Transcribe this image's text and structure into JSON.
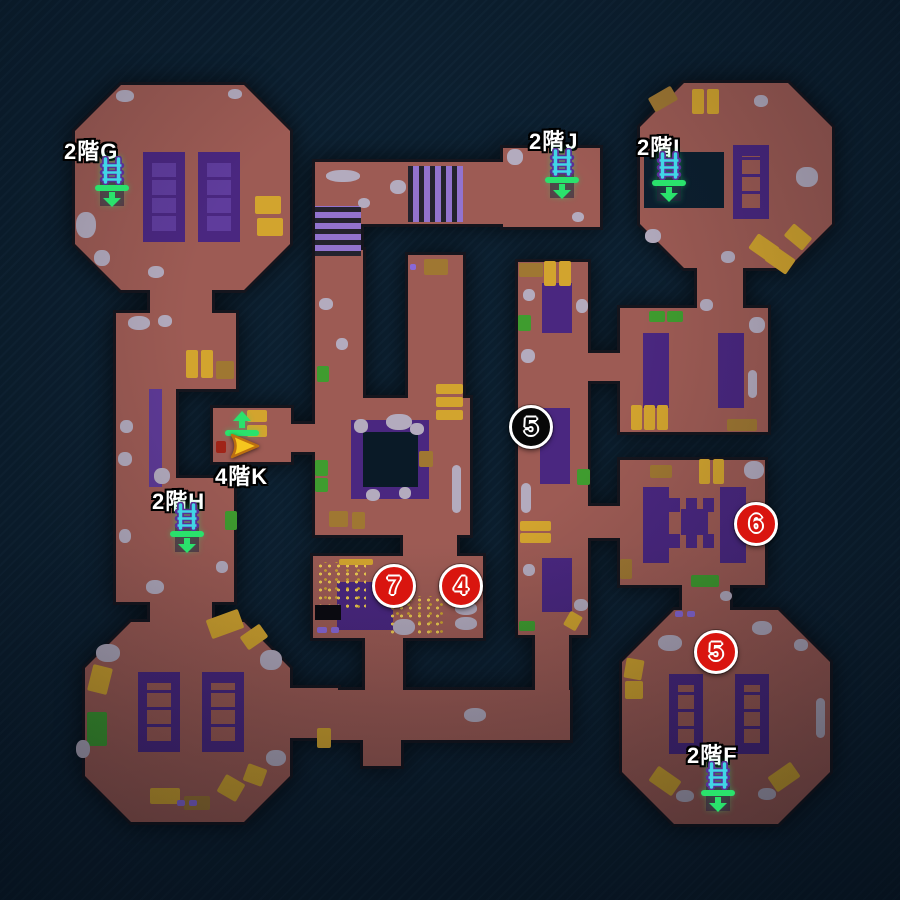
{
  "colors": {
    "background": "#0c1f2f",
    "floor": "#9d5b54",
    "wall": "#15151d",
    "carpet": "#4a2780",
    "marker_red": "#d9150f",
    "marker_black": "#070707",
    "marker_ring": "#ffffff",
    "stairs_green": "#2ae26c",
    "ladder_cyan": "#41d6e6",
    "player_arrow": "#f6c51e"
  },
  "labels": [
    {
      "id": "g",
      "text": "2階G"
    },
    {
      "id": "j",
      "text": "2階J"
    },
    {
      "id": "i",
      "text": "2階I"
    },
    {
      "id": "k",
      "text": "4階K"
    },
    {
      "id": "h",
      "text": "2階H"
    },
    {
      "id": "f",
      "text": "2階F"
    }
  ],
  "markers": [
    {
      "id": "center-5",
      "number": "5",
      "style": "black"
    },
    {
      "id": "east-6",
      "number": "6",
      "style": "red"
    },
    {
      "id": "treasure-7",
      "number": "7",
      "style": "red"
    },
    {
      "id": "treasure-4",
      "number": "4",
      "style": "red"
    },
    {
      "id": "southeast-5",
      "number": "5",
      "style": "red"
    }
  ],
  "icons": [
    {
      "id": "stairs-down-g",
      "type": "ladder-down"
    },
    {
      "id": "stairs-down-j",
      "type": "ladder-down"
    },
    {
      "id": "stairs-down-i",
      "type": "ladder-down"
    },
    {
      "id": "stairs-down-h",
      "type": "ladder-down"
    },
    {
      "id": "stairs-down-f",
      "type": "ladder-down"
    },
    {
      "id": "stairs-up-k",
      "type": "stairs-up"
    },
    {
      "id": "player-position",
      "type": "player-arrow"
    }
  ]
}
